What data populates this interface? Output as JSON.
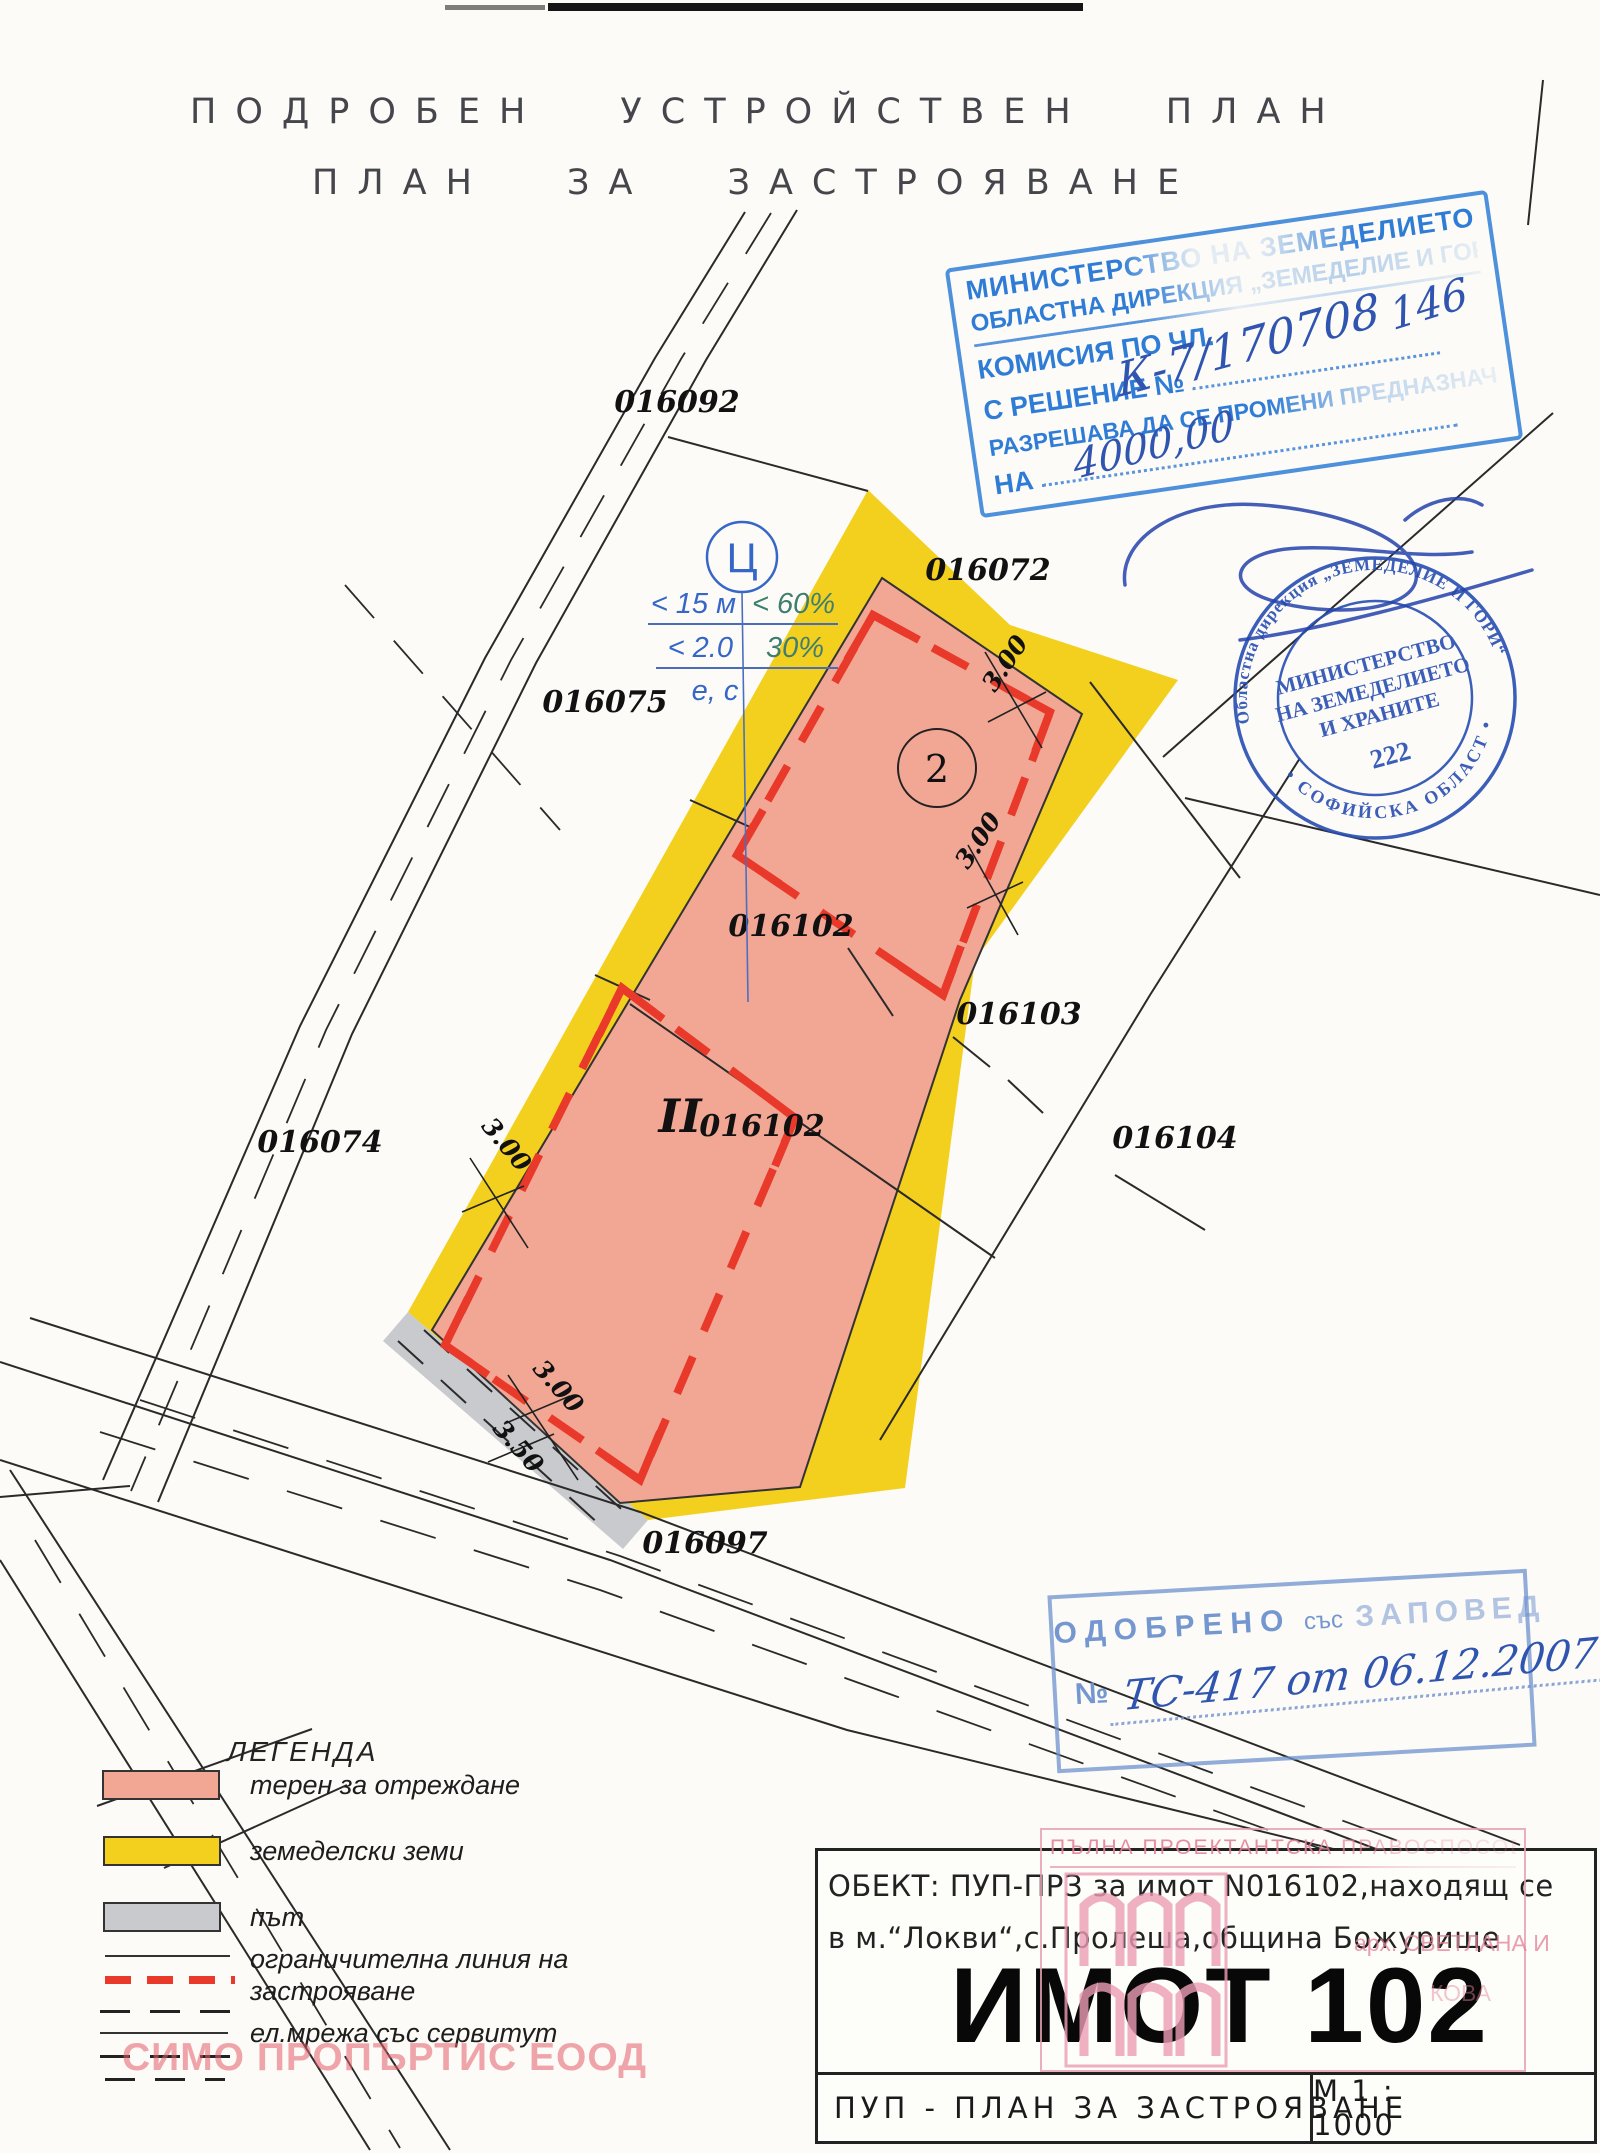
{
  "page_title_line1": "ПОДРОБЕН УСТРОЙСТВЕН ПЛАН",
  "page_title_line2": "ПЛАН ЗА ЗАСТРОЯВАНЕ",
  "ministry_stamp": {
    "line1": "МИНИСТЕРСТВО НА ЗЕМЕДЕЛИЕТО И ГОРИТЕ",
    "line2": "ОБЛАСТНА ДИРЕКЦИЯ „ЗЕМЕДЕЛИЕ И ГОРИ“",
    "line3": "КОМИСИЯ ПО ЧЛ.",
    "line4_label": "С РЕШЕНИЕ №",
    "line5": "РАЗРЕШАВА ДА СЕ ПРОМЕНИ ПРЕДНАЗНАЧЕНИЕТО",
    "line6_label": "НА",
    "hand_number": "К-7/170708",
    "hand_code": "146",
    "hand_amount": "4000,00"
  },
  "round_stamp": {
    "ring_top": "Областна дирекция „ЗЕМЕДЕЛИЕ И ГОРИ“",
    "ring_bottom": "• СОФИЙСКА ОБЛАСТ •",
    "center_line1": "МИНИСТЕРСТВО",
    "center_line2": "НА ЗЕМЕДЕЛИЕТО",
    "center_line3": "И ХРАНИТЕ",
    "number": "222"
  },
  "zone_symbol": {
    "letter": "Ц",
    "row1_left": "< 15 м",
    "row1_right": "< 60%",
    "row2_left": "< 2.0",
    "row2_right": "30%",
    "row3": "е, с"
  },
  "map_labels": {
    "p016092": "016092",
    "p016072": "016072",
    "p016075": "016075",
    "p016102": "016102",
    "p016103": "016103",
    "p016074": "016074",
    "p016104": "016104",
    "p016097": "016097",
    "zone2": "2",
    "zoneII": "II",
    "zoneII_num": "016102"
  },
  "dimensions": {
    "d1": "3.00",
    "d2": "3.00",
    "d3": "3.00",
    "d4": "3.00",
    "d5": "3.50"
  },
  "approved_stamp": {
    "word1": "ОДОБРЕНО",
    "word2": "със",
    "word3": "ЗАПОВЕД",
    "no_label": "№",
    "hand": "ТС-417 от 06.12.2007"
  },
  "architect_stamp": {
    "header": "ПЪЛНА ПРОЕКТАНТСКА ПРАВОСПОСОБНОСТ",
    "name": "арх. СВЕТЛАНА И",
    "name2": "КОВА"
  },
  "legend": {
    "title": "ЛЕГЕНДА",
    "items": [
      {
        "label": "терен за отреждане"
      },
      {
        "label": "земеделски земи"
      },
      {
        "label": "път"
      },
      {
        "label": "ограничителна линия на застрояване",
        "line1": "ограничителна линия на",
        "line2": "застрояване"
      },
      {
        "label": "ел.мрежа със сервитут"
      }
    ]
  },
  "title_block": {
    "object_line1": "ОБЕКТ: ПУП-ПРЗ  за имот  N016102,находящ се",
    "object_line2": "в м.“Локви“,с.Пролеша,община Божурище",
    "big": "ИМОТ 102",
    "plan": "ПУП - ПЛАН ЗА ЗАСТРОЯВАНЕ",
    "scale": "М 1 : 1000"
  },
  "watermark": "СИМО ПРОПЪРТИС ЕООД",
  "colors": {
    "salmon": "#f2a795",
    "yellow": "#f3cf1e",
    "road_gray": "#c9cacd",
    "red_dash": "#e8392a",
    "stamp_blue": "#2e7cd6",
    "round_stamp_blue": "#2b51b4",
    "approved_blue": "#6e91cd",
    "hand_blue": "#2f55b0",
    "pink": "#e8a0b4",
    "watermark_pink": "#e25c68",
    "teal_text": "#3f7e6f",
    "blue_text": "#3566c8"
  }
}
